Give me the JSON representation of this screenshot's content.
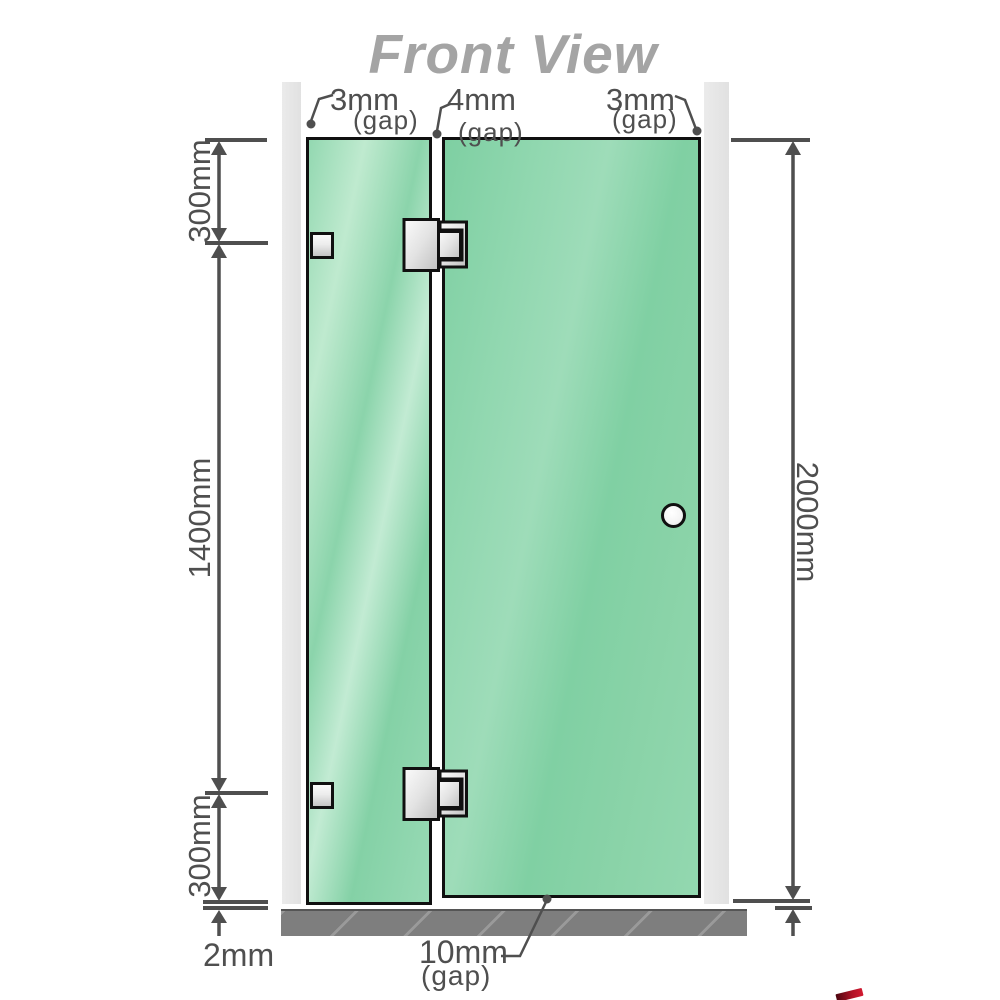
{
  "title": "Front View",
  "gap_labels": {
    "top_left": {
      "value": "3mm",
      "suffix": "(gap)"
    },
    "top_middle": {
      "value": "4mm",
      "suffix": "(gap)"
    },
    "top_right": {
      "value": "3mm",
      "suffix": "(gap)"
    },
    "bottom": {
      "value": "10mm",
      "suffix": "(gap)"
    }
  },
  "dimension_labels": {
    "upper_left": "300mm",
    "middle_left": "1400mm",
    "lower_left": "300mm",
    "right_height": "2000mm",
    "floor_gap": "2mm"
  },
  "colors": {
    "glass_green": "#86d3a8",
    "glass_highlight": "#c2ebd3",
    "wall_gray": "#e7e7e7",
    "floor_gray": "#7e7e7e",
    "outline_black": "#101010",
    "dimension_gray": "#4f4f4f",
    "title_gray": "#a4a4a4",
    "hinge_silver": "#e3e3e3",
    "watermark_red": "#b01226"
  }
}
